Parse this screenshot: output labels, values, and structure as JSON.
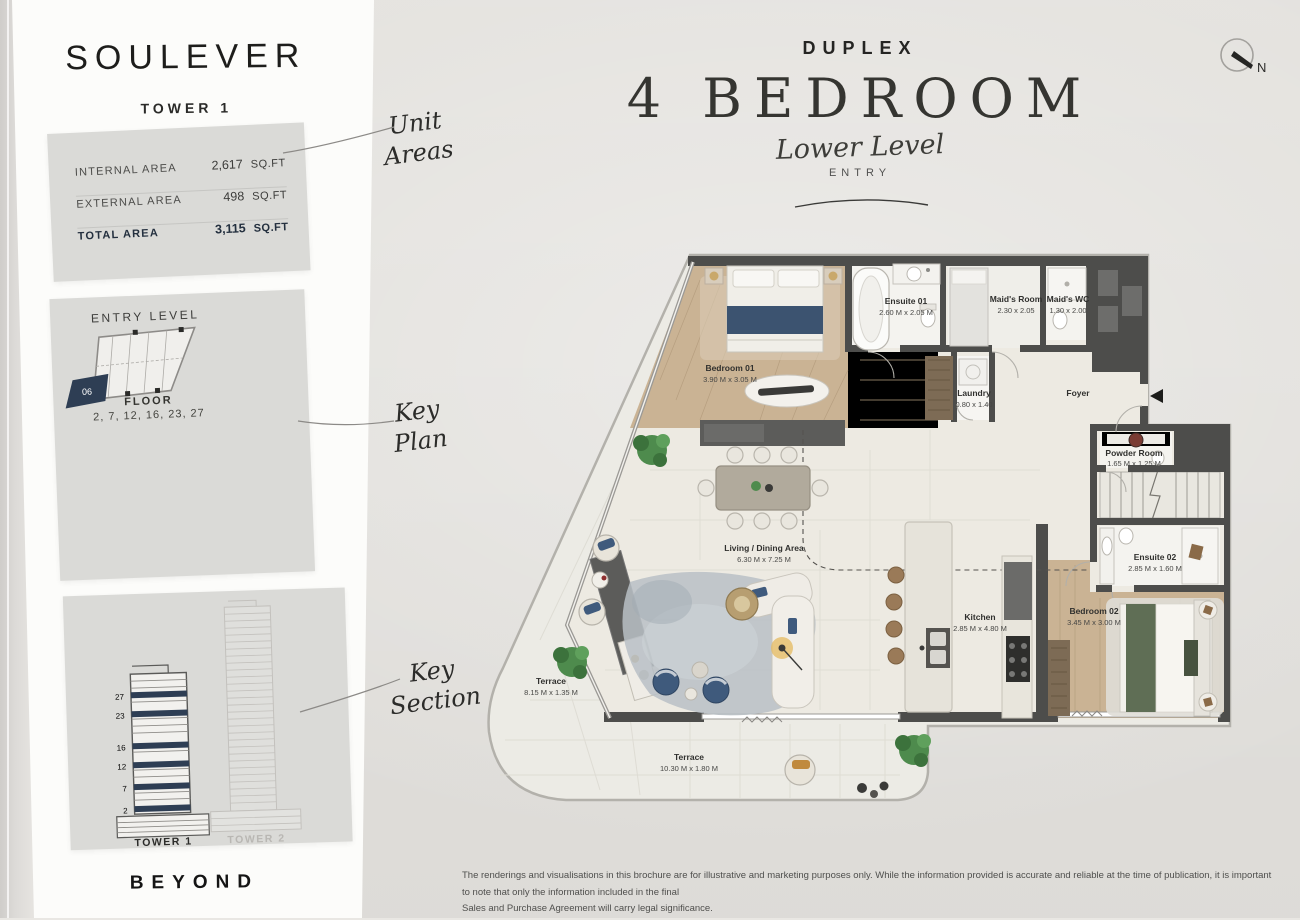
{
  "sidebar": {
    "logo": "SOULEVER",
    "tower": "TOWER 1",
    "areas": {
      "rows": [
        {
          "label": "INTERNAL AREA",
          "value": "2,617",
          "unit": "SQ.FT"
        },
        {
          "label": "EXTERNAL AREA",
          "value": "498",
          "unit": "SQ.FT"
        },
        {
          "label": "TOTAL AREA",
          "value": "3,115",
          "unit": "SQ.FT"
        }
      ]
    },
    "key_plan": {
      "title": "ENTRY LEVEL",
      "unit_number": "06",
      "floor_label": "FLOOR",
      "floors": "2, 7, 12, 16, 23, 27"
    },
    "key_section": {
      "floor_marks": [
        "27",
        "23",
        "16",
        "12",
        "7",
        "2"
      ],
      "tower1_label": "TOWER 1",
      "tower2_label": "TOWER 2"
    },
    "brand": "BEYOND"
  },
  "annotations": {
    "unit_areas": {
      "line1": "Unit",
      "line2": "Areas"
    },
    "key_plan": {
      "line1": "Key",
      "line2": "Plan"
    },
    "key_section": {
      "line1": "Key",
      "line2": "Section"
    }
  },
  "header": {
    "type": "DUPLEX",
    "title": "4 BEDROOM",
    "subtitle": "Lower Level",
    "level": "ENTRY"
  },
  "compass": {
    "label": "N"
  },
  "floor_plan": {
    "rooms": {
      "bedroom01": {
        "name": "Bedroom 01",
        "dims": "3.90 M x 3.05 M"
      },
      "ensuite01": {
        "name": "Ensuite 01",
        "dims": "2.60 M x 2.05 M"
      },
      "maids_room": {
        "name": "Maid's Room",
        "dims": "2.30 x 2.05"
      },
      "maids_wc": {
        "name": "Maid's WC",
        "dims": "1.30 x 2.00"
      },
      "laundry": {
        "name": "Laundry",
        "dims": "0.80 x 1.40"
      },
      "foyer": {
        "name": "Foyer"
      },
      "powder": {
        "name": "Powder Room",
        "dims": "1.65 M x 1.25 M"
      },
      "ensuite02": {
        "name": "Ensuite 02",
        "dims": "2.85 M x 1.60 M"
      },
      "bedroom02": {
        "name": "Bedroom 02",
        "dims": "3.45 M x 3.00 M"
      },
      "living": {
        "name": "Living / Dining Area",
        "dims": "6.30 M x 7.25 M"
      },
      "kitchen": {
        "name": "Kitchen",
        "dims": "2.85 M x 4.80 M"
      },
      "terrace_side": {
        "name": "Terrace",
        "dims": "8.15 M x 1.35 M"
      },
      "terrace_bottom": {
        "name": "Terrace",
        "dims": "10.30 M x 1.80 M"
      }
    }
  },
  "footer": {
    "line1": "The renderings and visualisations in this brochure are for illustrative and marketing purposes only. While the information provided is accurate and reliable at the time of publication, it is important to note that only the information included in the final",
    "line2": "Sales and Purchase Agreement will carry legal significance."
  },
  "colors": {
    "accent_navy": "#2e3e54",
    "wall_gray": "#4d4d4b",
    "wood": "#c8b193",
    "paper": "#e9e7e3",
    "panel": "#fcfcfa",
    "box_gray": "#dadad7",
    "plant_green": "#4e8b4d",
    "chair_navy": "#3f5a7c",
    "runner_green": "#5f6e55"
  }
}
